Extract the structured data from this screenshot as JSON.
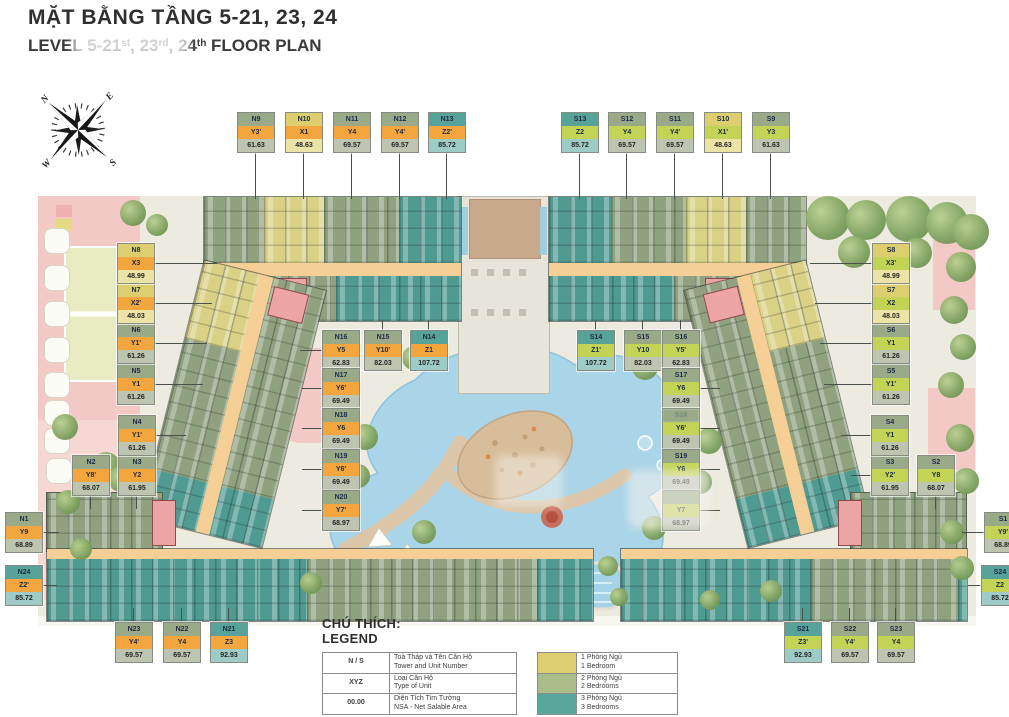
{
  "title": {
    "vi": "MẶT BẰNG TẦNG 5-21, 23, 24",
    "en_p1": "LEVEL 5-21",
    "en_s1": "st",
    "en_p2": ", 23",
    "en_s2": "rd",
    "en_p3": ", 24",
    "en_s3": "th",
    "en_p4": " FLOOR PLAN"
  },
  "compass": {
    "n": "N",
    "e": "E",
    "s": "S",
    "w": "W"
  },
  "legend": {
    "heading_vi": "CHÚ THÍCH:",
    "heading_en": "LEGEND",
    "rows": [
      {
        "key": "N / S",
        "vi": "Toà Tháp và Tên Căn Hộ",
        "en": "Tower and Unit Number"
      },
      {
        "key": "XYZ",
        "vi": "Loại Căn Hộ",
        "en": "Type of Unit"
      },
      {
        "key": "00.00",
        "vi": "Diện Tích Tim Tường",
        "en": "NSA - Net Salable Area"
      }
    ],
    "types": [
      {
        "color": "#ddcf6f",
        "vi": "1 Phòng Ngủ",
        "en": "1 Bedroom"
      },
      {
        "color": "#a9bd8a",
        "vi": "2 Phòng Ngủ",
        "en": "2 Bedrooms"
      },
      {
        "color": "#57a79d",
        "vi": "3 Phòng Ngủ",
        "en": "3 Bedrooms"
      }
    ]
  },
  "colors": {
    "tower_n_type_band": "#f4a63e",
    "tower_s_type_band": "#c3d355",
    "bedroom1": "#ddcf6f",
    "bedroom2": "#9aaa88",
    "bedroom3": "#57a39a",
    "corridor": "#f6cf96",
    "core": "#eda4a4",
    "pool": "#aad4e7",
    "deck": "#dcc6a9",
    "landscape": "#f3c9c6"
  },
  "units": [
    {
      "id": "N1",
      "tower_label": "N1",
      "type": "Y9",
      "area": "68.89"
    },
    {
      "id": "N2",
      "tower_label": "N2",
      "type": "Y8'",
      "area": "68.07"
    },
    {
      "id": "N3",
      "tower_label": "N3",
      "type": "Y2",
      "area": "61.95"
    },
    {
      "id": "N4",
      "tower_label": "N4",
      "type": "Y1'",
      "area": "61.26"
    },
    {
      "id": "N5",
      "tower_label": "N5",
      "type": "Y1",
      "area": "61.26"
    },
    {
      "id": "N6",
      "tower_label": "N6",
      "type": "Y1'",
      "area": "61.26"
    },
    {
      "id": "N7",
      "tower_label": "N7",
      "type": "X2'",
      "area": "48.03"
    },
    {
      "id": "N8",
      "tower_label": "N8",
      "type": "X3",
      "area": "48.99"
    },
    {
      "id": "N9",
      "tower_label": "N9",
      "type": "Y3'",
      "area": "61.63"
    },
    {
      "id": "N10",
      "tower_label": "N10",
      "type": "X1",
      "area": "48.63"
    },
    {
      "id": "N11",
      "tower_label": "N11",
      "type": "Y4",
      "area": "69.57"
    },
    {
      "id": "N12",
      "tower_label": "N12",
      "type": "Y4'",
      "area": "69.57"
    },
    {
      "id": "N13",
      "tower_label": "N13",
      "type": "Z2'",
      "area": "85.72"
    },
    {
      "id": "N14",
      "tower_label": "N14",
      "type": "Z1",
      "area": "107.72"
    },
    {
      "id": "N15",
      "tower_label": "N15",
      "type": "Y10'",
      "area": "82.03"
    },
    {
      "id": "N16",
      "tower_label": "N16",
      "type": "Y5",
      "area": "62.83"
    },
    {
      "id": "N17",
      "tower_label": "N17",
      "type": "Y6'",
      "area": "69.49"
    },
    {
      "id": "N18",
      "tower_label": "N18",
      "type": "Y6",
      "area": "69.49"
    },
    {
      "id": "N19",
      "tower_label": "N19",
      "type": "Y6'",
      "area": "69.49"
    },
    {
      "id": "N20",
      "tower_label": "N20",
      "type": "Y7'",
      "area": "68.97"
    },
    {
      "id": "N21",
      "tower_label": "N21",
      "type": "Z3",
      "area": "92.93"
    },
    {
      "id": "N22",
      "tower_label": "N22",
      "type": "Y4",
      "area": "69.57"
    },
    {
      "id": "N23",
      "tower_label": "N23",
      "type": "Y4'",
      "area": "69.57"
    },
    {
      "id": "N24",
      "tower_label": "N24",
      "type": "Z2'",
      "area": "85.72"
    },
    {
      "id": "S1",
      "tower_label": "S1",
      "type": "Y9'",
      "area": "68.89"
    },
    {
      "id": "S2",
      "tower_label": "S2",
      "type": "Y8",
      "area": "68.07"
    },
    {
      "id": "S3",
      "tower_label": "S3",
      "type": "Y2'",
      "area": "61.95"
    },
    {
      "id": "S4",
      "tower_label": "S4",
      "type": "Y1",
      "area": "61.26"
    },
    {
      "id": "S5",
      "tower_label": "S5",
      "type": "Y1'",
      "area": "61.26"
    },
    {
      "id": "S6",
      "tower_label": "S6",
      "type": "Y1",
      "area": "61.26"
    },
    {
      "id": "S7",
      "tower_label": "S7",
      "type": "X2",
      "area": "48.03"
    },
    {
      "id": "S8",
      "tower_label": "S8",
      "type": "X3'",
      "area": "48.99"
    },
    {
      "id": "S9",
      "tower_label": "S9",
      "type": "Y3",
      "area": "61.63"
    },
    {
      "id": "S10",
      "tower_label": "S10",
      "type": "X1'",
      "area": "48.63"
    },
    {
      "id": "S11",
      "tower_label": "S11",
      "type": "Y4'",
      "area": "69.57"
    },
    {
      "id": "S12",
      "tower_label": "S12",
      "type": "Y4",
      "area": "69.57"
    },
    {
      "id": "S13",
      "tower_label": "S13",
      "type": "Z2",
      "area": "85.72"
    },
    {
      "id": "S14",
      "tower_label": "S14",
      "type": "Z1'",
      "area": "107.72"
    },
    {
      "id": "S15",
      "tower_label": "S15",
      "type": "Y10",
      "area": "82.03"
    },
    {
      "id": "S16",
      "tower_label": "S16",
      "type": "Y5'",
      "area": "62.83"
    },
    {
      "id": "S17",
      "tower_label": "S17",
      "type": "Y6",
      "area": "69.49"
    },
    {
      "id": "S18",
      "tower_label": "S18",
      "type": "Y6'",
      "area": "69.49",
      "faint": true
    },
    {
      "id": "S19",
      "tower_label": "S19",
      "type": "Y6",
      "area": "69.49"
    },
    {
      "id": "S20",
      "tower_label": "",
      "type": "Y7",
      "area": "68.97"
    },
    {
      "id": "S21",
      "tower_label": "S21",
      "type": "Z3'",
      "area": "92.93"
    },
    {
      "id": "S22",
      "tower_label": "S22",
      "type": "Y4'",
      "area": "69.57"
    },
    {
      "id": "S23",
      "tower_label": "S23",
      "type": "Y4",
      "area": "69.57"
    },
    {
      "id": "S24",
      "tower_label": "S24",
      "type": "Z2",
      "area": "85.72"
    }
  ]
}
